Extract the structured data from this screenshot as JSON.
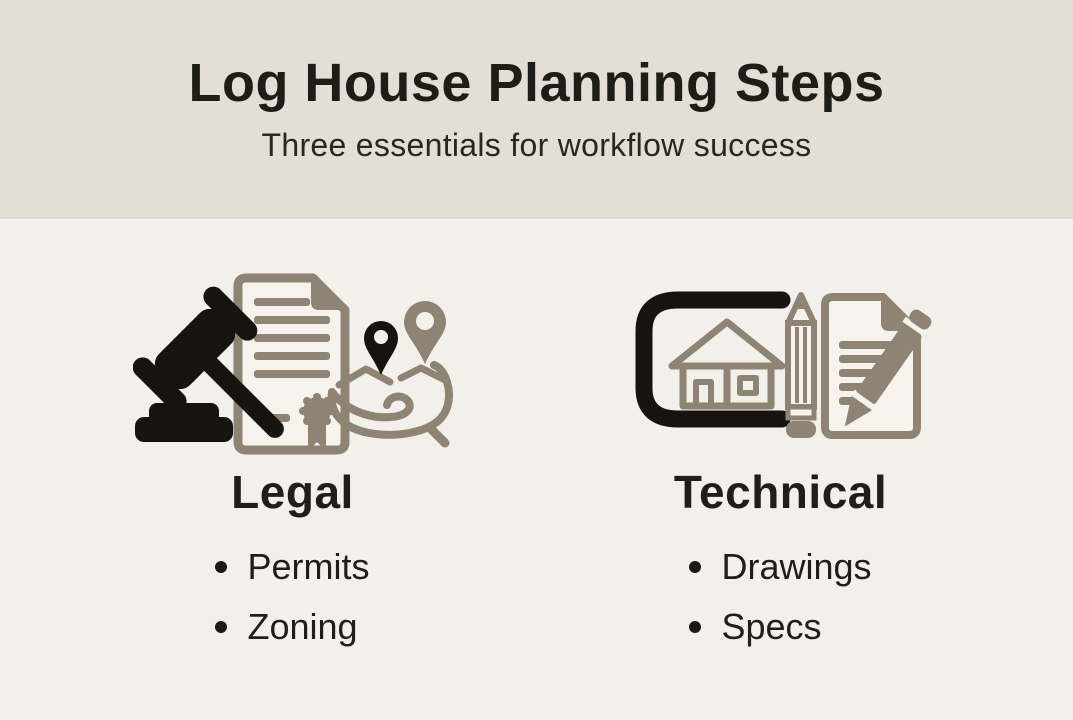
{
  "page": {
    "title": "Log House Planning Steps",
    "subtitle": "Three essentials for workflow success"
  },
  "colors": {
    "header_bg": "#e4ded6",
    "body_bg": "#f2f0ea",
    "text": "#211e19",
    "icon_black": "#17140f",
    "icon_taupe": "#8f8473",
    "paper_fill": "#f6f3ed"
  },
  "columns": [
    {
      "id": "legal",
      "heading": "Legal",
      "icons": [
        "gavel-icon",
        "certificate-document-icon",
        "hand-location-pins-icon"
      ],
      "items": [
        "Permits",
        "Zoning"
      ]
    },
    {
      "id": "technical",
      "heading": "Technical",
      "icons": [
        "blueprint-house-icon",
        "pencil-icon",
        "document-edit-icon"
      ],
      "items": [
        "Drawings",
        "Specs"
      ]
    }
  ]
}
